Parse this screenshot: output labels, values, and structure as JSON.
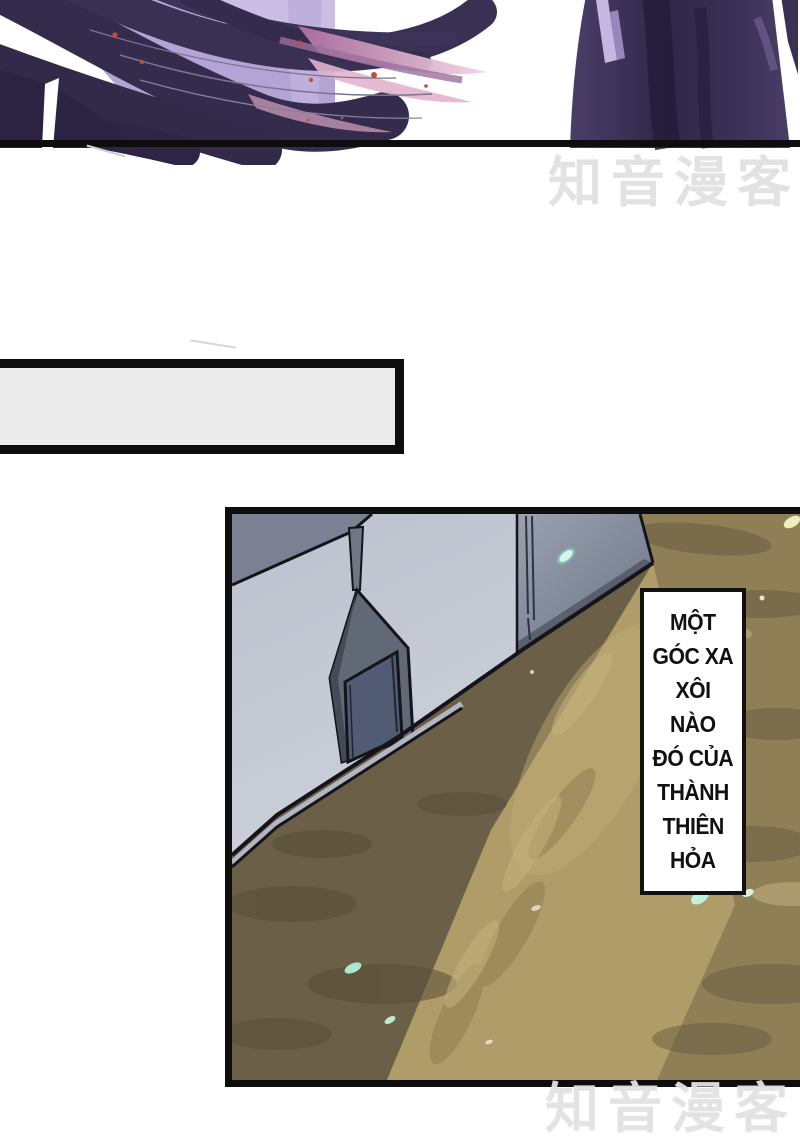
{
  "watermarks": {
    "top": "知音漫客",
    "bottom": "知音漫客",
    "color": "#e2e2e2"
  },
  "caption_box": {
    "text": ""
  },
  "narration_box": {
    "lines": [
      "MỘT",
      "GÓC XA",
      "XÔI",
      "NÀO",
      "ĐÓ CỦA",
      "THÀNH",
      "THIÊN",
      "HỎA"
    ],
    "text_color": "#111111",
    "fill": "#ffffff"
  },
  "colors": {
    "panelBorder": "#0d0d0d",
    "watermark": "#e2e2e2",
    "boxFill": "#ebebeb",
    "narrFill": "#ffffff",
    "wallLight": "#c1c6d2",
    "wallSide": "#8e96a8",
    "roof": "#7b8192",
    "alcove": "#616876",
    "door": "#515c74",
    "groundBase": "#8f7f57",
    "groundDark": "#6b6047",
    "groundLight": "#b09c68",
    "hairDark": "#352b4d",
    "hairLavender": "#b2a4d4",
    "hairPink": "#d795bb",
    "robe": "#3a2f54",
    "petal": "#b9eedd",
    "speck": "#bf4f3a"
  }
}
